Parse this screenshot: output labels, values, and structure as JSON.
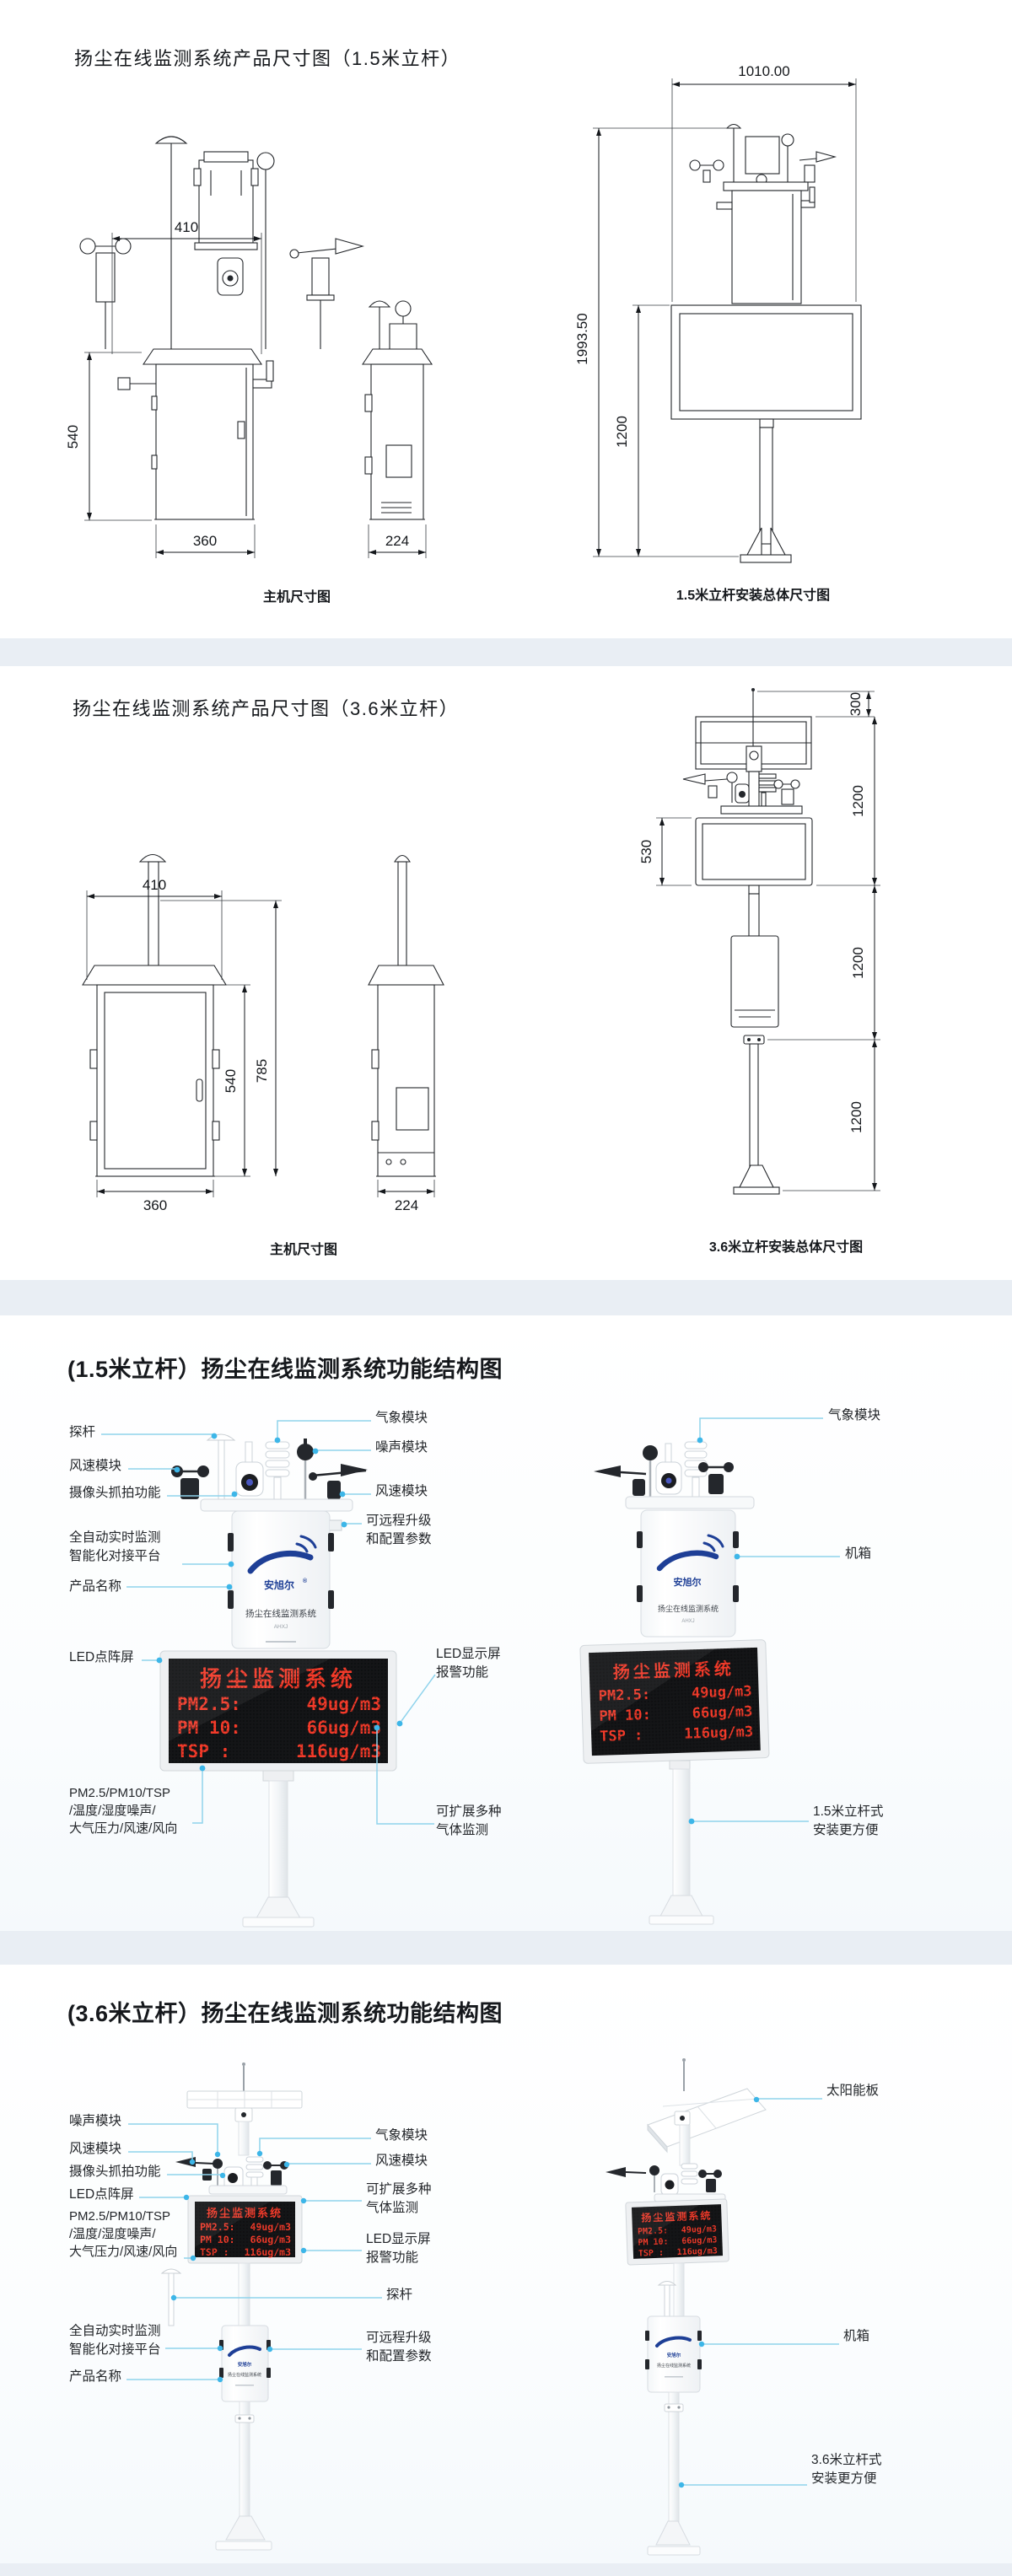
{
  "colors": {
    "accent": "#3db6e8",
    "callout_line": "#8fd3ec",
    "led_red": "#f43b2a",
    "led_bg": "#141517",
    "band": "#e9eef4",
    "logo_blue": "#1e3f96"
  },
  "device": {
    "brand": "安旭尔",
    "reg": "®",
    "name": "扬尘在线监测系统",
    "model": "AHXJ"
  },
  "led": {
    "title": "扬尘监测系统",
    "rows": [
      {
        "n": "PM2.5:",
        "v": "49ug/m3"
      },
      {
        "n": "PM 10:",
        "v": "66ug/m3"
      },
      {
        "n": "TSP  :",
        "v": "116ug/m3"
      }
    ]
  },
  "s1": {
    "title": "扬尘在线监测系统产品尺寸图（1.5米立杆）",
    "cap_main": "主机尺寸图",
    "cap_pole": "1.5米立杆安装总体尺寸图",
    "dims": {
      "w410": "410",
      "h540": "540",
      "w360": "360",
      "w224": "224",
      "w1010": "1010.00",
      "h1993": "1993.50",
      "h1200": "1200"
    }
  },
  "s2": {
    "title": "扬尘在线监测系统产品尺寸图（3.6米立杆）",
    "cap_main": "主机尺寸图",
    "cap_pole": "3.6米立杆安装总体尺寸图",
    "dims": {
      "w410": "410",
      "h540": "540",
      "h785": "785",
      "w360": "360",
      "w224": "224",
      "h300": "300",
      "h530": "530",
      "h1200a": "1200",
      "h1200b": "1200",
      "h1200c": "1200"
    }
  },
  "s3": {
    "title": "(1.5米立杆）扬尘在线监测系统功能结构图",
    "labels": {
      "l1": "探杆",
      "l2": "风速模块",
      "l3": "摄像头抓拍功能",
      "l4": "全自动实时监测\n智能化对接平台",
      "l5": "产品名称",
      "l6": "LED点阵屏",
      "l7": "PM2.5/PM10/TSP\n/温度/湿度噪声/\n大气压力/风速/风向",
      "m1": "气象模块",
      "m2": "噪声模块",
      "m3": "风速模块",
      "m4": "可远程升级\n和配置参数",
      "m5": "LED显示屏\n报警功能",
      "m6": "可扩展多种\n气体监测",
      "r1": "气象模块",
      "r2": "机箱",
      "r3": "1.5米立杆式\n安装更方便"
    }
  },
  "s4": {
    "title": "(3.6米立杆）扬尘在线监测系统功能结构图",
    "labels": {
      "l1": "噪声模块",
      "l2": "风速模块",
      "l3": "摄像头抓拍功能",
      "l4": "LED点阵屏",
      "l5": "PM2.5/PM10/TSP\n/温度/湿度噪声/\n大气压力/风速/风向",
      "l6": "全自动实时监测\n智能化对接平台",
      "l7": "产品名称",
      "m1": "气象模块",
      "m2": "风速模块",
      "m3": "可扩展多种\n气体监测",
      "m4": "LED显示屏\n报警功能",
      "m5": "探杆",
      "m6": "可远程升级\n和配置参数",
      "r1": "太阳能板",
      "r2": "机箱",
      "r3": "3.6米立杆式\n安装更方便"
    }
  }
}
